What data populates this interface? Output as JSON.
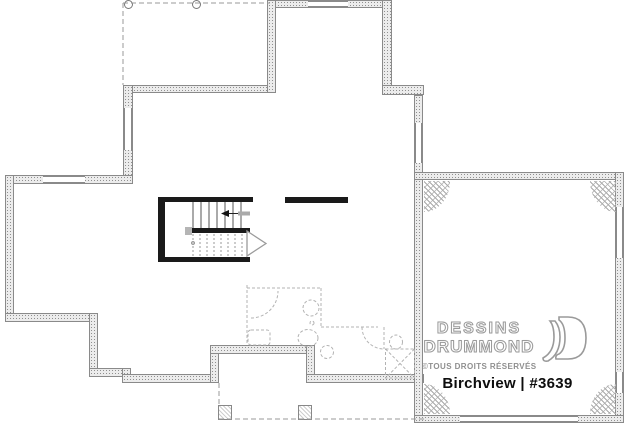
{
  "branding": {
    "line1": "DESSINS",
    "line2": "DRUMMOND",
    "rights": "©TOUS DROITS RÉSERVÉS",
    "plan_title": "Birchview | #3639",
    "logo_outline_color": "#9a9a9a",
    "title_color": "#0d0d0d"
  },
  "plan": {
    "type": "basement-foundation-floor-plan",
    "colors": {
      "wall_fill": "#ececec",
      "wall_line": "#8a8a8a",
      "black_wall": "#1a1a1a",
      "dashed_rough_in": "#b3b3b3",
      "dashed_porch": "#999999"
    },
    "features": {
      "top_porch": "deck outline above with 2 round posts",
      "stairs": "u-shaped staircase, up-arrow to the left",
      "future_bathroom": "dashed rough-in: doors, sink, toilet, vanity, sump, shower",
      "rear_porch": "dashed covered porch with 2 square posts",
      "garage": "garage with hatched corner footing pads, garage door opening at bottom, 2 side windows"
    }
  }
}
